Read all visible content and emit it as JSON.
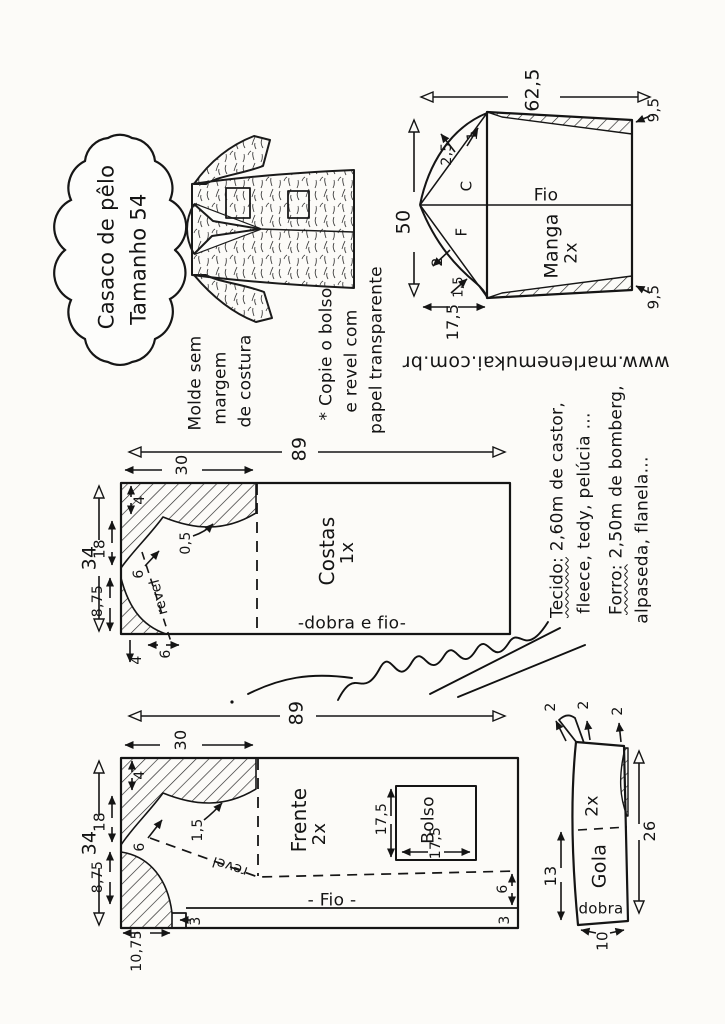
{
  "header": {
    "title_line1": "Casaco de pêlo",
    "title_line2": "Tamanho 54"
  },
  "notes": {
    "molde_line1": "Molde sem",
    "molde_line2": "margem",
    "molde_line3": "de costura",
    "copie_line1": "* Copie o bolso",
    "copie_line2": "e revel com",
    "copie_line3": "papel transparente",
    "website": "www.marlenemukai.com.br"
  },
  "fabric": {
    "tecido_head": "Tecido:",
    "tecido_rest": " 2,60m de castor,",
    "line2": "fleece, tedy, pelúcia ...",
    "forro_head": "Forro:",
    "forro_rest": " 2,50m de bomberg,",
    "line4": "alpaseda, flanela..."
  },
  "manga": {
    "name": "Manga",
    "qty": "2x",
    "grain": "Fio",
    "back_letter": "C",
    "front_letter": "F",
    "width": "62,5",
    "height": "50",
    "underarm": "17,5",
    "hem_top": "9,5",
    "hem_bottom": "9,5",
    "cap_back_notch": "2,5",
    "cap_back_top": "1",
    "cap_front_notch": "2",
    "cap_front_base": "1,5"
  },
  "costas": {
    "name": "Costas",
    "qty": "1x",
    "fold_label": "-dobra e fio-",
    "width": "89",
    "height": "34",
    "shoulder": "30",
    "drop": "4",
    "armhole": "18",
    "hip": "8,75",
    "notch": "6",
    "curve": "0,5",
    "revel": "revel",
    "hem_drop": "4",
    "hem_in": "6"
  },
  "frente": {
    "name": "Frente",
    "qty": "2x",
    "grain": "- Fio -",
    "width": "89",
    "height": "34",
    "shoulder": "30",
    "drop": "4",
    "armhole": "18",
    "hip": "8,75",
    "front_edge": "10,75",
    "notch": "6",
    "curve": "1,5",
    "revel": "revel",
    "ext": "3",
    "hem_gap": "6",
    "hem": "3",
    "bolso_name": "Bolso",
    "bolso_h": "17,5",
    "bolso_w": "17,5"
  },
  "gola": {
    "name": "Gola",
    "qty": "2x",
    "fold_label": "dobra",
    "tip_a": "2",
    "tip_b": "2",
    "tip_c": "2",
    "half": "13",
    "length": "26",
    "width10": "10"
  }
}
